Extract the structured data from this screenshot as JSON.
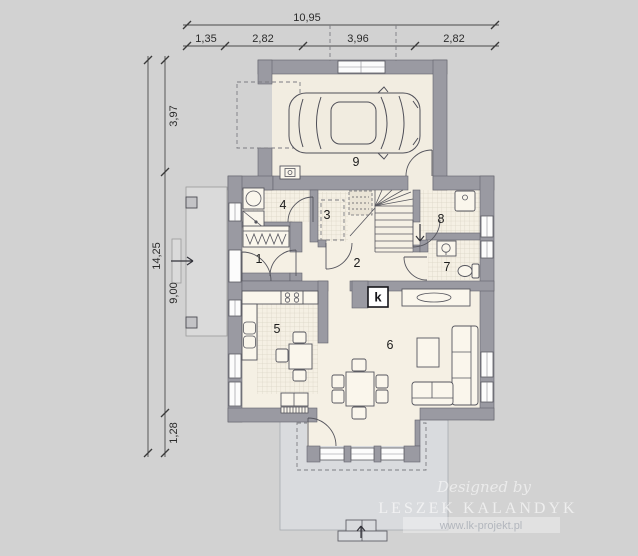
{
  "plan": {
    "dim_top_total": "10,95",
    "dim_top_segments": [
      "1,35",
      "2,82",
      "3,96",
      "2,82"
    ],
    "dim_left_total": "14,25",
    "dim_left_segments": [
      "3,97",
      "9,00",
      "1,28"
    ],
    "room_labels": {
      "r1": "1",
      "r2": "2",
      "r3": "3",
      "r4": "4",
      "r5": "5",
      "r6": "6",
      "r7": "7",
      "r8": "8",
      "r9": "9"
    },
    "fireplace_label": "k",
    "watermark": {
      "designed_by": "Designed by",
      "studio": "LESZEK KALANDYK",
      "website": "www.lk-projekt.pl"
    },
    "colors": {
      "background": "#d2d2d2",
      "wall": "#9a9aa2",
      "floor": "#f5f0e4",
      "tile_line": "#d9d3c4",
      "terrace": "#d9dbde",
      "outline": "#56565e"
    }
  }
}
